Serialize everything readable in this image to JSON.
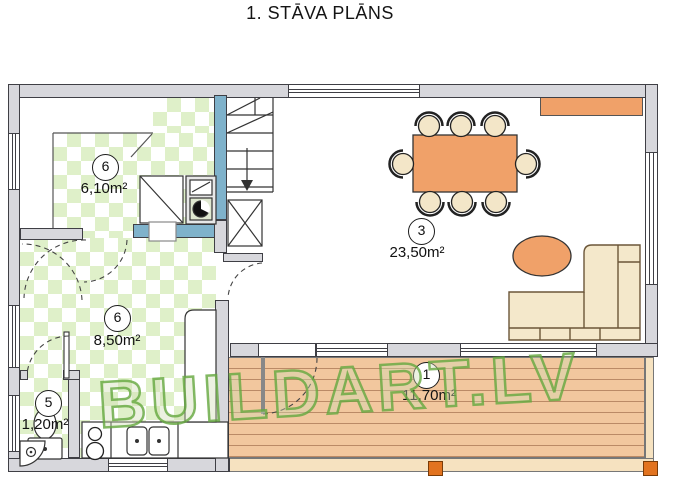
{
  "title": "1. STĀVA PLĀNS",
  "watermark": "BUILDART.LV",
  "rooms": [
    {
      "number": "6",
      "area": "6,10m²"
    },
    {
      "number": "6",
      "area": "8,50m²"
    },
    {
      "number": "5",
      "area": "1,20m²"
    },
    {
      "number": "3",
      "area": "23,50m²"
    },
    {
      "number": "1",
      "area": "11,70m²"
    }
  ],
  "colors": {
    "wall_gray": "#d7d7dc",
    "plumbing_wall_blue": "#7fb2cb",
    "tile_green": "#dff0c9",
    "furniture_orange": "#f0a169",
    "upholstery_cream": "#f3e6c8",
    "deck_wood": "#f2c79e",
    "watermark_green": "#64a83e",
    "post_orange": "#e2731f"
  }
}
